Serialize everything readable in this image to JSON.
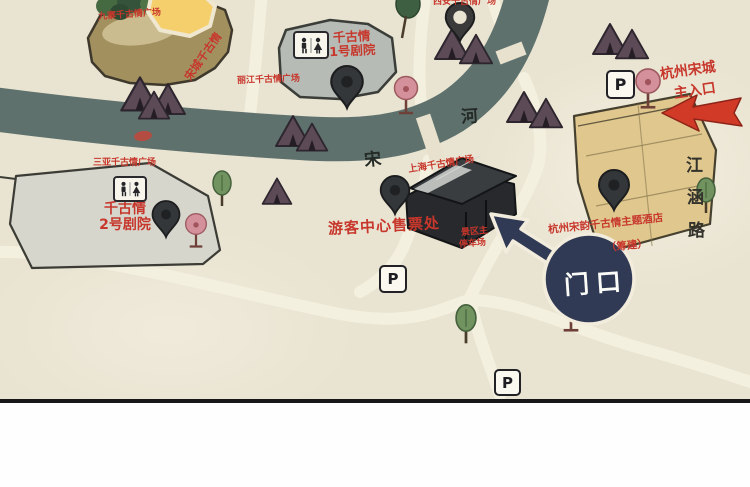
{
  "labels": {
    "hill_square": "九寨千古情广场",
    "hill_slope": "宋城千古情",
    "lijiang_square": "丽江千古情广场",
    "top_square": "西安千古情广场",
    "sanya_square": "三亚千古情广场",
    "shanghai_square": "上海千古情广场",
    "theater1_line1": "千古情",
    "theater1_line2": "1号剧院",
    "theater2_line1": "千古情",
    "theater2_line2": "2号剧院",
    "ticket_office": "游客中心售票处",
    "hotel_line1": "杭州宋韵千古情主题酒店",
    "hotel_line2": "（筹建）",
    "entrance_line1": "杭州宋城",
    "entrance_line2": "主入口",
    "parking_exit_line1": "景区主",
    "parking_exit_line2": "停车场",
    "gate_bubble": "门口",
    "street_char_1": "江",
    "street_char_2": "涵",
    "street_char_3": "路",
    "river_char_1": "宋",
    "river_char_2": "河",
    "parking_sign": "P"
  },
  "icons": {
    "parking": "white square with black letter P",
    "toilet": "white plaque with man and woman figures",
    "location_pin": "dark teardrop map pin",
    "green_tree": "round green tree",
    "pink_tree": "round pink blossom tree on trunk",
    "house": "purple tent-roof village house",
    "entrance_arrow": "red arrow pointing left",
    "gate_arrow_bubble": "navy circle with arrow pointing up-left"
  },
  "colors": {
    "map_background": "#e9e3d1",
    "river": "#5e716d",
    "road": "#f4f0df",
    "red_label": "#c7372c",
    "hill_brown": "#a3905f",
    "theater_gray": "#b7bbb5",
    "theater_light_gray": "#d7d6cc",
    "ticket_building_dark": "#27292c",
    "hotel_tan": "#e0c78e",
    "house_plum": "#5c4a57",
    "pink_tree": "#d4919b",
    "green_tree": "#71935f",
    "gate_bubble_navy": "#313a55",
    "entrance_arrow_red": "#d23a28",
    "bottom_border": "#17171a"
  }
}
